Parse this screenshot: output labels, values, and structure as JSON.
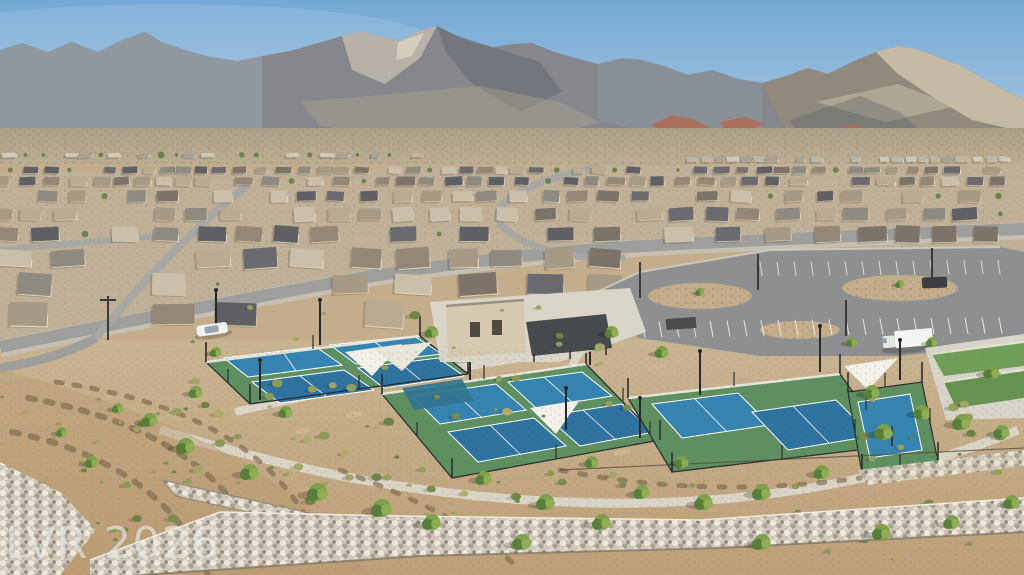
{
  "meta": {
    "type": "aerial-photograph",
    "subject": "Aerial drone view of a desert master-planned community: pickleball courts with shade sails and clubhouse in foreground, parking lot, rows of tan single-story homes, desert bajada and mountain range under a blue sky",
    "watermark_note": "real-estate photo watermark, bottom left"
  },
  "watermark": {
    "text": "LVR 2026"
  },
  "palette": {
    "sky_top": "#74a9d6",
    "sky_horizon": "#ccdde9",
    "mtn_base": "#85878c",
    "mtn_haze": "#96a1ac",
    "mtn_light": "#c3bcae",
    "mtn_shadow": "#5d6169",
    "mtn_right": "#8f897d",
    "mtn_right_light": "#d2c7ad",
    "red_hill": "#b06a50",
    "bajada_top": "#aca08a",
    "bajada_bottom": "#c2b295",
    "housing_base": "#c0b097",
    "road": "#9e9e9c",
    "road_minor": "#a8a7a3",
    "sidewalk": "#d8d3c6",
    "asphalt": "#8e8f91",
    "concrete": "#d9d5c9",
    "court_green": "#5e8f60",
    "court_green_dark": "#4d7d52",
    "court_blue": "#3583b0",
    "court_blue_deep": "#2e72a0",
    "fence": "#2b2e30",
    "sail_white": "#f3f1e9",
    "sail_teal": "#2f7390",
    "lawn": "#6f9e58",
    "dirt": "#c3ad8b",
    "dirt_deep": "#b5925f",
    "rock_light": "#d8d1c2",
    "rock_dark": "#77705f",
    "shrub": "#7a8b4f",
    "tree": "#7fa04b",
    "tree_dark": "#597e3c",
    "truck_white": "#f4f4f2",
    "suv_dark": "#3c3e42",
    "watermark_color": "#ebebe9",
    "roofs": [
      "#8f8a80",
      "#a79a85",
      "#6b6b6f",
      "#b9ab93",
      "#948776",
      "#7c7468",
      "#cabfa8",
      "#5f6064"
    ],
    "walls": [
      "#d9cfba",
      "#cfc0a6",
      "#e2d8c4",
      "#d6cab2"
    ]
  }
}
